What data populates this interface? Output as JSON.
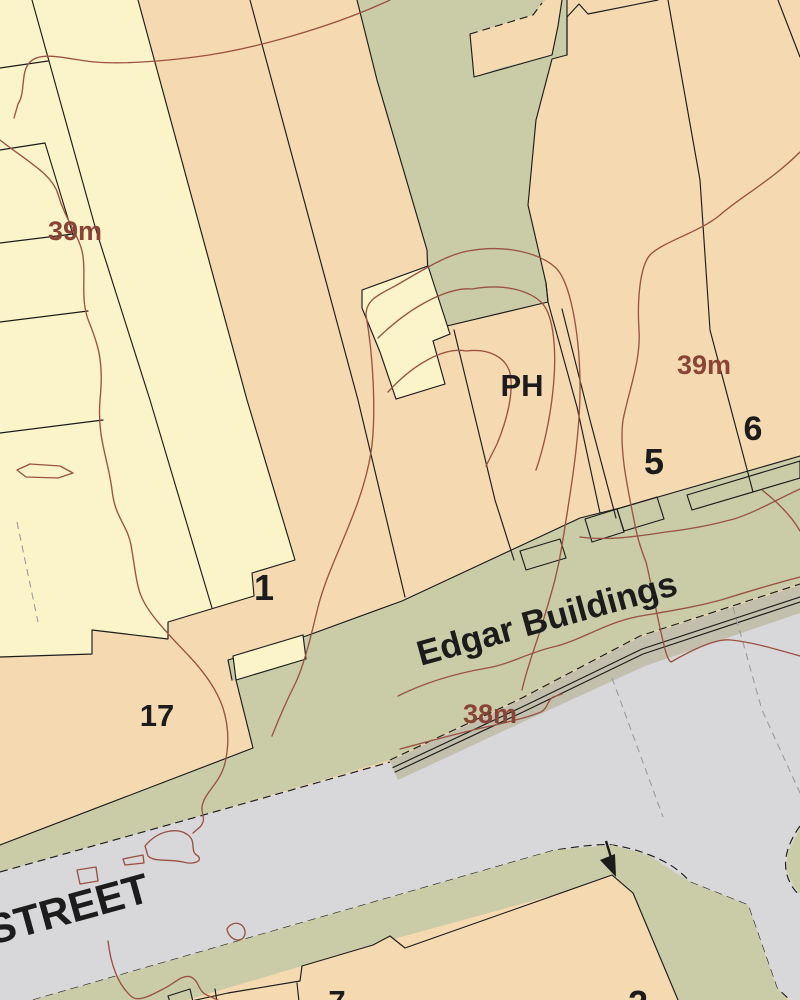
{
  "map": {
    "labels": {
      "spot_height_left": {
        "text": "39m"
      },
      "spot_height_right": {
        "text": "39m"
      },
      "spot_height_street": {
        "text": "38m"
      },
      "pub": {
        "text": "PH"
      },
      "building_no_1": {
        "text": "1"
      },
      "building_no_5": {
        "text": "5"
      },
      "building_no_6": {
        "text": "6"
      },
      "building_no_17": {
        "text": "17"
      },
      "building_no_7": {
        "text": "7"
      },
      "building_no_2_partial": {
        "text": "2"
      },
      "terrace_name": {
        "text": "Edgar Buildings"
      },
      "street_name": {
        "text": "STREET"
      }
    },
    "colors": {
      "building_cream": "#fbf4c8",
      "building_orange": "#f5d9b0",
      "verge_green": "#c9cca7",
      "road_gray": "#d8d7da",
      "band_olive": "#c2c0ac",
      "contour_brown": "#9b5243",
      "label_brown": "#8a4335",
      "line_black": "#1c1c1c",
      "dash_gray": "#9b9ba1"
    },
    "icons": {
      "arrow": "entrance-arrow"
    }
  }
}
